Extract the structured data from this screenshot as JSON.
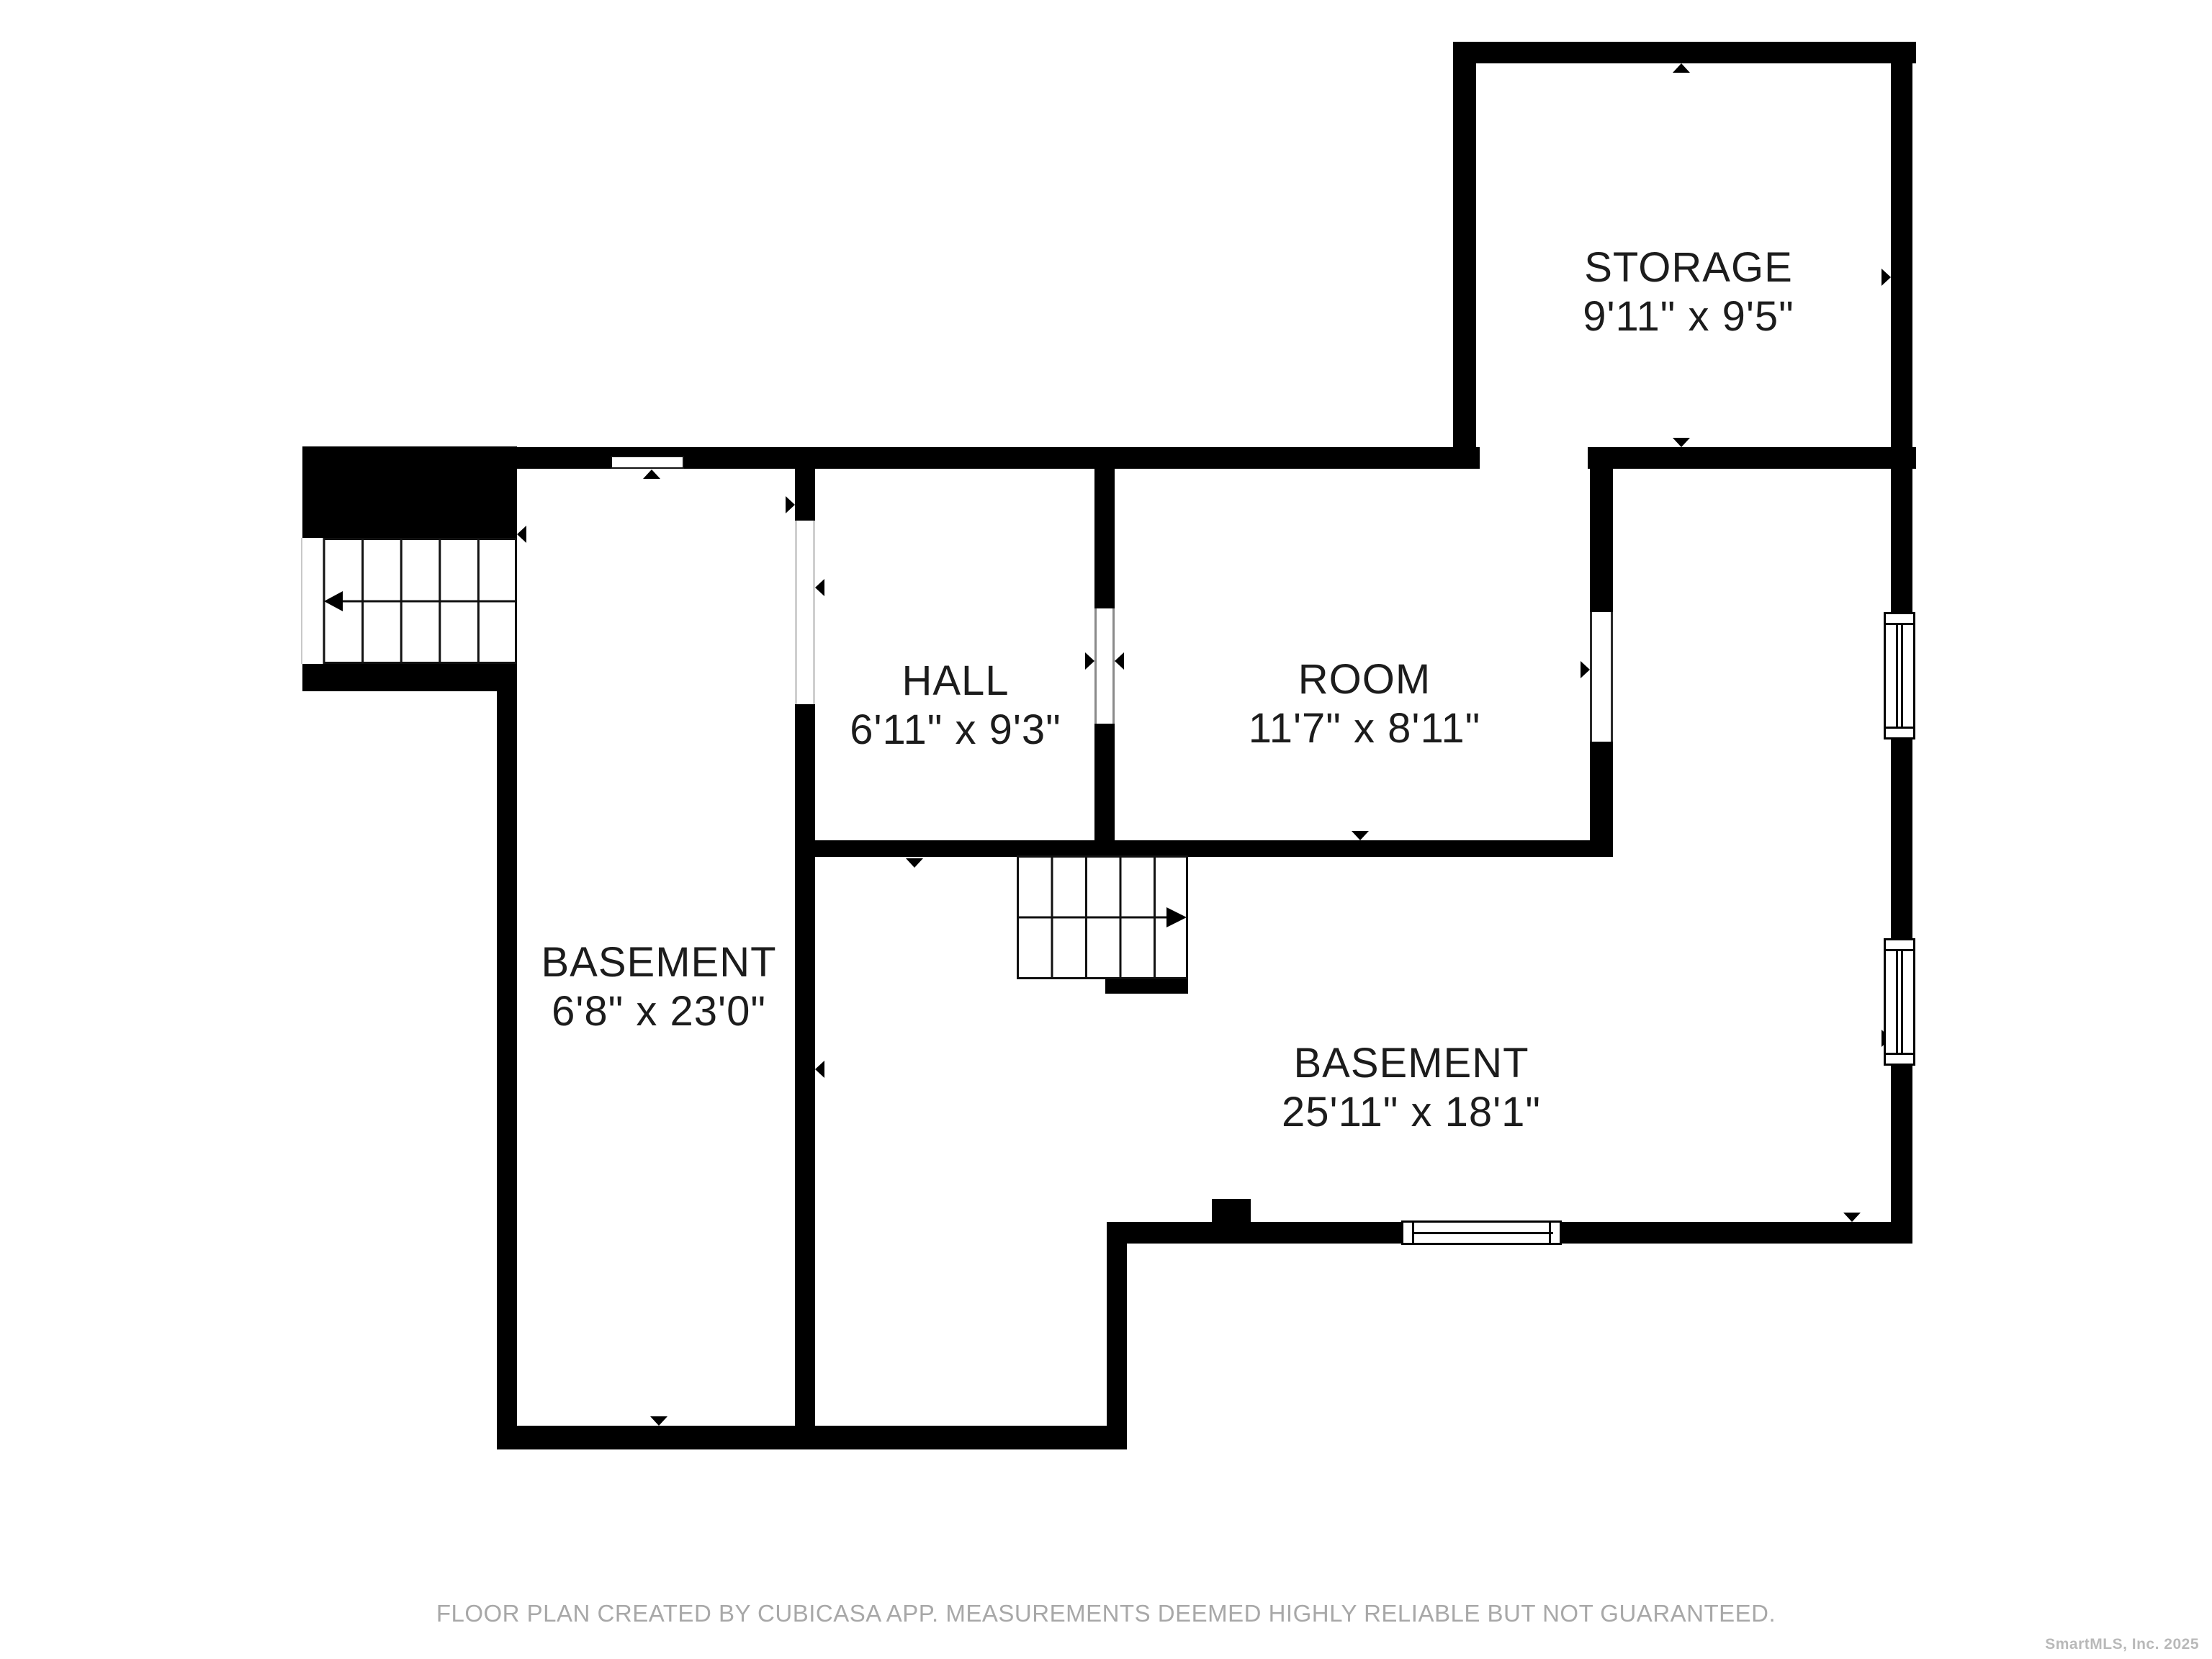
{
  "rooms": {
    "storage": {
      "name": "STORAGE",
      "dims": "9'11\" x 9'5\""
    },
    "hall": {
      "name": "HALL",
      "dims": "6'11\" x 9'3\""
    },
    "room": {
      "name": "ROOM",
      "dims": "11'7\" x 8'11\""
    },
    "basement_small": {
      "name": "BASEMENT",
      "dims": "6'8\" x 23'0\""
    },
    "basement_large": {
      "name": "BASEMENT",
      "dims": "25'11\" x 18'1\""
    }
  },
  "footer": {
    "disclaimer": "FLOOR PLAN CREATED BY CUBICASA APP. MEASUREMENTS DEEMED HIGHLY RELIABLE BUT NOT GUARANTEED."
  },
  "watermark": {
    "text": "SmartMLS, Inc.  2025"
  },
  "colors": {
    "wall": "#000000",
    "room_label": "#1c1c1c",
    "footer_text": "#a8a8a8",
    "watermark_text": "#b9b9b9",
    "stair_line": "#111111",
    "faint_opening_line": "#c9c9c9",
    "background": "#ffffff"
  }
}
